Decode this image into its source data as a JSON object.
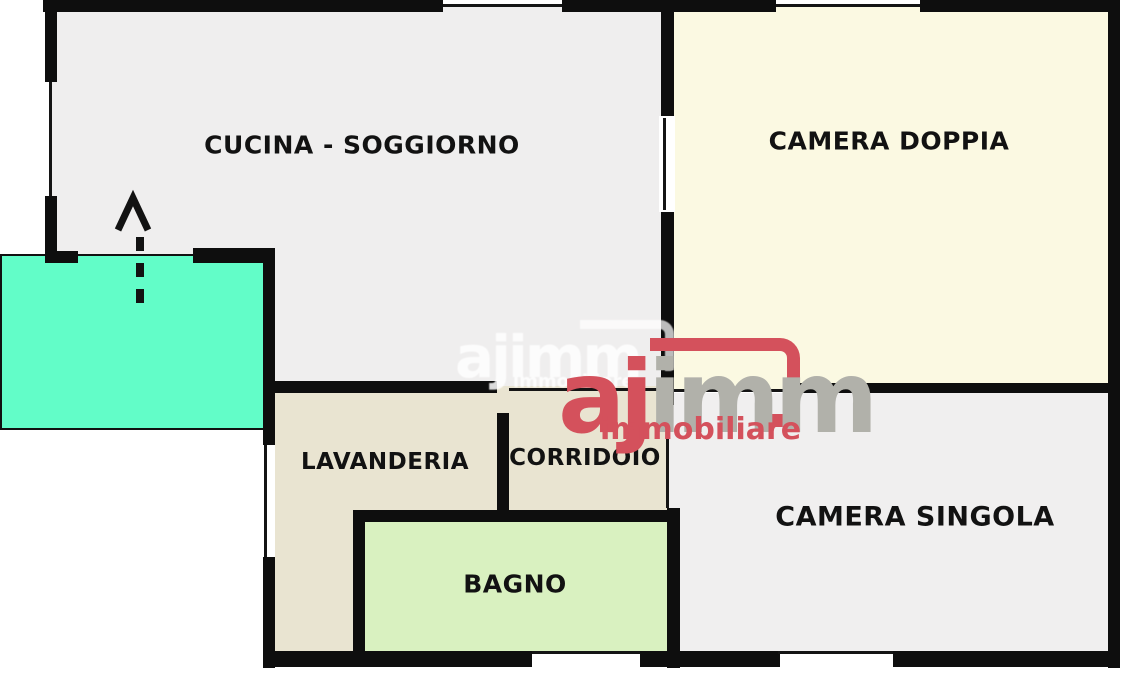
{
  "plan": {
    "title": "apartment floor plan",
    "wall_color": "#0e0e0e",
    "rooms": [
      {
        "id": "cucina-soggiorno",
        "label": "CUCINA - SOGGIORNO",
        "color": "#efeeee"
      },
      {
        "id": "camera-doppia",
        "label": "CAMERA DOPPIA",
        "color": "#fbf9e2"
      },
      {
        "id": "lavanderia",
        "label": "LAVANDERIA",
        "color": "#e9e4d1"
      },
      {
        "id": "corridoio",
        "label": "CORRIDOIO",
        "color": "#e9e4d1"
      },
      {
        "id": "bagno",
        "label": "BAGNO",
        "color": "#d9f1c0"
      },
      {
        "id": "camera-singola",
        "label": "CAMERA SINGOLA",
        "color": "#f0efef"
      },
      {
        "id": "balcone",
        "label": "",
        "color": "#62fdc8"
      }
    ]
  },
  "watermark": {
    "brand_aj": "aj",
    "brand_imm": "imm",
    "subtitle": "immobiliare",
    "red": "#d4515c",
    "gray": "#b1b1aa"
  }
}
